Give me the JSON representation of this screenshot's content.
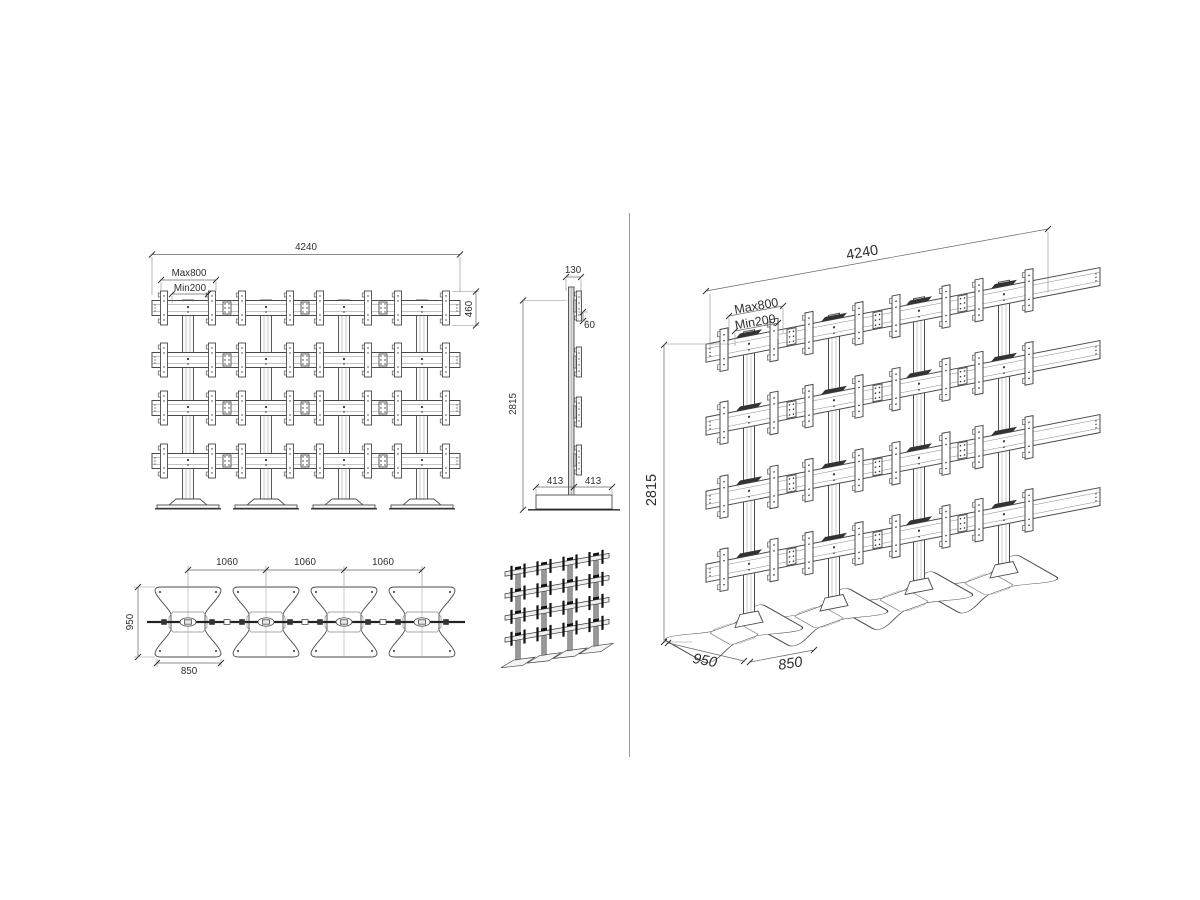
{
  "drawing": {
    "front_view": {
      "width": "4240",
      "vesa_max": "Max800",
      "vesa_min": "Min200",
      "bracket_height": "460"
    },
    "side_view": {
      "top_depth": "130",
      "bracket_offset": "60",
      "height": "2815",
      "base_front": "413",
      "base_back": "413"
    },
    "top_view": {
      "spacing": [
        "1060",
        "1060",
        "1060"
      ],
      "base_depth": "950",
      "base_width": "850"
    },
    "perspective_view": {
      "width": "4240",
      "vesa_max": "Max800",
      "vesa_min": "Min200",
      "height": "2815",
      "base_depth": "950",
      "base_width": "850"
    },
    "colors": {
      "line": "#4a4a4a",
      "dark": "#1a1a1a",
      "dim_line": "#666666",
      "text": "#2e2e2e",
      "background": "#ffffff"
    }
  }
}
